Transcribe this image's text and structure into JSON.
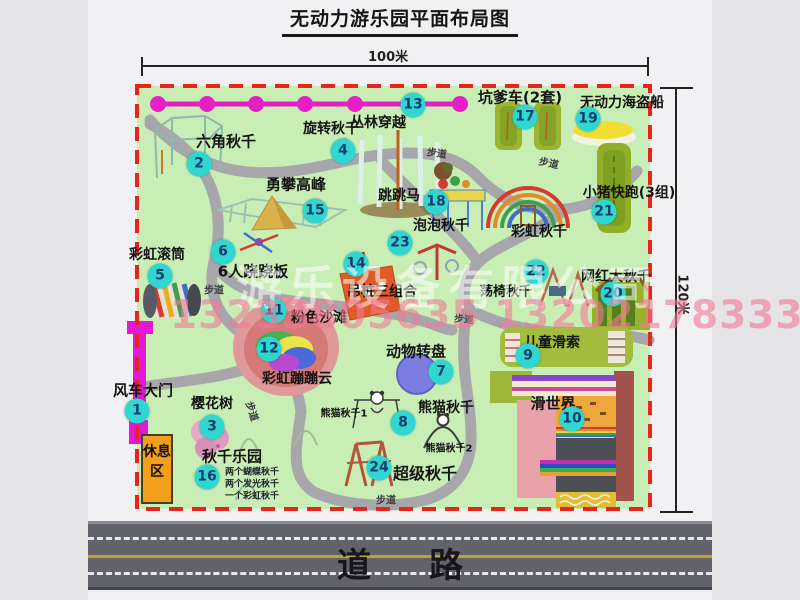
{
  "title": "无动力游乐园平面布局图",
  "dimensions": {
    "width": "100米",
    "height": "120米"
  },
  "road": {
    "label": "道路"
  },
  "watermark": {
    "company": "游乐设备有限公司",
    "phone": "13233805635 13202178333"
  },
  "rest_area": {
    "label": "休息区"
  },
  "map": {
    "pois": [
      {
        "num": "1",
        "label": "风车大门",
        "bx": 137,
        "by": 411,
        "lx": 143,
        "ly": 390,
        "fs": 15
      },
      {
        "num": "2",
        "label": "六角秋千",
        "bx": 199,
        "by": 164,
        "lx": 226,
        "ly": 141,
        "fs": 15
      },
      {
        "num": "3",
        "label": "樱花树",
        "bx": 212,
        "by": 427,
        "lx": 212,
        "ly": 403,
        "fs": 14
      },
      {
        "num": "4",
        "label": "旋转秋千",
        "bx": 343,
        "by": 151,
        "lx": 331,
        "ly": 128,
        "fs": 14
      },
      {
        "num": "5",
        "label": "彩虹滚筒",
        "bx": 160,
        "by": 276,
        "lx": 157,
        "ly": 254,
        "fs": 14
      },
      {
        "num": "6",
        "label": "6人跷跷板",
        "bx": 223,
        "by": 252,
        "lx": 253,
        "ly": 271,
        "fs": 15
      },
      {
        "num": "7",
        "label": "动物转盘",
        "bx": 441,
        "by": 372,
        "lx": 416,
        "ly": 351,
        "fs": 15
      },
      {
        "num": "8",
        "label": "熊猫秋千",
        "bx": 403,
        "by": 423,
        "lx": 446,
        "ly": 407,
        "fs": 14
      },
      {
        "num": "9",
        "label": "儿童滑索",
        "bx": 528,
        "by": 356,
        "lx": 552,
        "ly": 342,
        "fs": 14
      },
      {
        "num": "10",
        "label": "滑世界",
        "bx": 572,
        "by": 419,
        "lx": 553,
        "ly": 403,
        "fs": 15
      },
      {
        "num": "11",
        "label": "粉色沙滩",
        "bx": 274,
        "by": 311,
        "lx": 319,
        "ly": 317,
        "fs": 14
      },
      {
        "num": "12",
        "label": "彩虹蹦蹦云",
        "bx": 269,
        "by": 349,
        "lx": 297,
        "ly": 378,
        "fs": 14
      },
      {
        "num": "13",
        "label": "丛林穿越",
        "bx": 413,
        "by": 105,
        "lx": 378,
        "ly": 122,
        "fs": 14
      },
      {
        "num": "14",
        "label": "吊桩三组合",
        "bx": 356,
        "by": 264,
        "lx": 382,
        "ly": 291,
        "fs": 14
      },
      {
        "num": "15",
        "label": "勇攀高峰",
        "bx": 315,
        "by": 211,
        "lx": 296,
        "ly": 184,
        "fs": 15
      },
      {
        "num": "16",
        "label": "秋千乐园",
        "bx": 207,
        "by": 477,
        "lx": 232,
        "ly": 456,
        "fs": 15,
        "sub": [
          "两个蝴蝶秋千",
          "两个发光秋千",
          "一个彩虹秋千"
        ],
        "subx": 252,
        "suby": 471
      },
      {
        "num": "17",
        "label": "坑爹车(2套)",
        "bx": 525,
        "by": 117,
        "lx": 520,
        "ly": 97,
        "fs": 15
      },
      {
        "num": "18",
        "label": "跳跳马",
        "bx": 436,
        "by": 202,
        "lx": 399,
        "ly": 195,
        "fs": 14
      },
      {
        "num": "19",
        "label": "无动力海盗船",
        "bx": 588,
        "by": 119,
        "lx": 622,
        "ly": 102,
        "fs": 14
      },
      {
        "num": "20",
        "label": "网红大秋千",
        "bx": 613,
        "by": 294,
        "lx": 616,
        "ly": 276,
        "fs": 14
      },
      {
        "num": "21",
        "label": "小猪快跑(3组)",
        "bx": 604,
        "by": 212,
        "lx": 629,
        "ly": 192,
        "fs": 14
      },
      {
        "num": "22",
        "label": "荡椅秋千",
        "bx": 536,
        "by": 272,
        "lx": 506,
        "ly": 290,
        "fs": 13
      },
      {
        "num": "23",
        "label": "泡泡秋千",
        "bx": 400,
        "by": 243,
        "lx": 441,
        "ly": 225,
        "fs": 14
      },
      {
        "num": "24",
        "label": "超级秋千",
        "bx": 379,
        "by": 468,
        "lx": 425,
        "ly": 472,
        "fs": 16
      }
    ],
    "extra_labels": [
      {
        "text": "彩虹秋千",
        "x": 539,
        "y": 231,
        "fs": 14
      },
      {
        "text": "熊猫秋千1",
        "x": 344,
        "y": 412,
        "fs": 10
      },
      {
        "text": "熊猫秋千2",
        "x": 449,
        "y": 447,
        "fs": 10
      }
    ],
    "walkway_labels": [
      {
        "text": "步道",
        "x": 341,
        "y": 147,
        "rot": -48
      },
      {
        "text": "步道",
        "x": 437,
        "y": 152,
        "rot": 8
      },
      {
        "text": "步道",
        "x": 549,
        "y": 162,
        "rot": 12
      },
      {
        "text": "步道",
        "x": 214,
        "y": 289,
        "rot": 0
      },
      {
        "text": "步道",
        "x": 464,
        "y": 318,
        "rot": 5
      },
      {
        "text": "步道",
        "x": 253,
        "y": 411,
        "rot": 72
      },
      {
        "text": "步道",
        "x": 386,
        "y": 499,
        "rot": 0
      }
    ]
  },
  "colors": {
    "map_green": "#c9eeb5",
    "border_red": "#e8251d",
    "path_gray": "#a7a7ab",
    "badge_cyan": "#2fd7d0",
    "zipline_magenta": "#e520c6",
    "road_gray": "#62626a",
    "rest_area_orange": "#f2a01c",
    "gate_magenta": "#e318d2"
  }
}
